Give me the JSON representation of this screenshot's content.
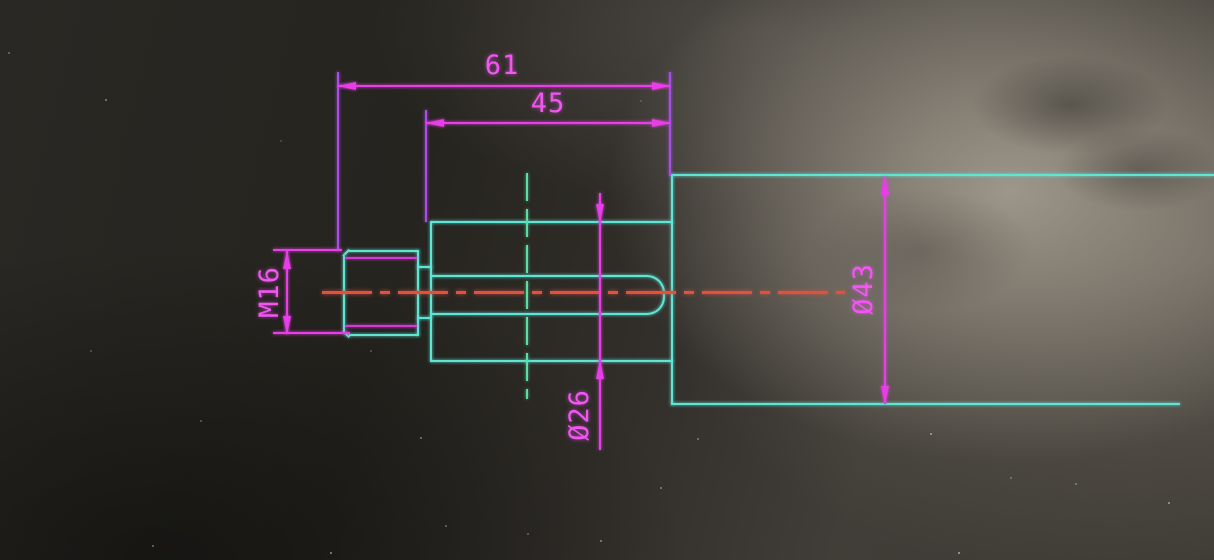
{
  "scene": {
    "description": "Photograph of a monitor showing a 2D CAD technical drawing of a stepped shaft with an M16 threaded end, a 26 mm diameter middle section with keyway slot, and a 43 mm diameter body"
  },
  "labels": {
    "len61": "61",
    "len45": "45",
    "m16": "M16",
    "dia26": "Ø26",
    "dia43": "Ø43"
  },
  "dimensions": [
    {
      "value": "61",
      "kind": "length",
      "orientation": "horizontal",
      "measures": "thread start to large-body face"
    },
    {
      "value": "45",
      "kind": "length",
      "orientation": "horizontal",
      "measures": "mid cylinder length"
    },
    {
      "value": "M16",
      "kind": "thread-callout",
      "orientation": "vertical",
      "measures": "thread outer diameter"
    },
    {
      "value": "Ø26",
      "kind": "diameter",
      "orientation": "vertical",
      "measures": "mid cylinder diameter"
    },
    {
      "value": "Ø43",
      "kind": "diameter",
      "orientation": "vertical",
      "measures": "large body diameter"
    }
  ],
  "colors": {
    "outline": "#5de5d6",
    "dimension": "#e83ee8",
    "dimension_text": "#f156f1",
    "extension": "#a74ee6",
    "thread_line": "#d13ad6",
    "centerline_horizontal": "#e2503e",
    "centerline_vertical": "#58e0a2",
    "background_dark": "#24221f",
    "background_highlight": "#a29c90"
  }
}
